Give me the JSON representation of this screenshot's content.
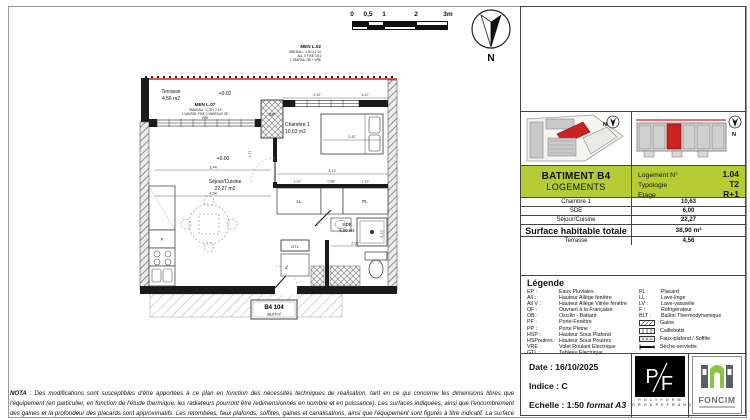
{
  "colors": {
    "accent_green": "#b5cc35",
    "highlight_red": "#cc2222"
  },
  "north_label": "N",
  "scalebar": {
    "labels": [
      "0",
      "0,5",
      "1",
      "2",
      "3m"
    ]
  },
  "plan": {
    "terrasse_label": "Terrasse",
    "terrasse_area": "4,56 m2",
    "level_top": "+0.02",
    "level_main": "+0.00",
    "men_l07": {
      "name": "MEN L.07",
      "l1": "TABLEAU : 2,70 x 2,19",
      "l2": "1 VANTAIL FIXE  2 VANTAUX OF",
      "l3": "VRE"
    },
    "men_l02": {
      "name": "MEN L.02",
      "l1": "TABLEAU : 1,00 x 2,10",
      "l2": "ALL V FIXE 0,91",
      "l3": "1 VANTAIL OB + VRE"
    },
    "chambre_label": "Chambre 1",
    "chambre_area": "10,63 m2",
    "sejour_label": "Séjour/Cuisine",
    "sejour_area": "22,27 m2",
    "sde_label": "SDE",
    "sde_area": "6,00 m2",
    "ep": "EP",
    "gtl": "GTL",
    "ll": "LL",
    "pl_closet": "PL",
    "pl_hall": "PL",
    "fridge": "F",
    "tag_line1": "B4 104",
    "tag_line2": "38,67m²",
    "dims": {
      "top1": "2,57",
      "top2": "3,47",
      "bed": "2,87",
      "mid": "3,12",
      "c1": "1,10",
      "c2": "0,88",
      "c3": "1,29",
      "sej1": "3,44",
      "sej2": "4,54",
      "sej_h": "1,71",
      "sde_w": "2,02",
      "sde_h": "2,10"
    }
  },
  "titleblock": {
    "batiment": "BATIMENT B4",
    "sublabel": "LOGEMENTS",
    "fields": [
      {
        "label": "Logement N°",
        "value": "1.04"
      },
      {
        "label": "Typologie",
        "value": "T2"
      },
      {
        "label": "Etage",
        "value": "R+1"
      }
    ],
    "rows": [
      {
        "label": "Chambre 1",
        "value": "10,63"
      },
      {
        "label": "SDE",
        "value": "6,00"
      },
      {
        "label": "Séjour/Cuisine",
        "value": "22,27"
      }
    ],
    "total_label": "Surface habitable totale",
    "total_value": "38,90 m²",
    "extra_row": {
      "label": "Terrasse",
      "value": "4,56"
    }
  },
  "legend": {
    "title": "Légende",
    "abbr_left": [
      {
        "abbr": "EP :",
        "desc": "Eaux Pluviales"
      },
      {
        "abbr": "All :",
        "desc": "Hauteur Allège fenêtre"
      },
      {
        "abbr": "All V :",
        "desc": "Hauteur Allège Vitrée fenêtre"
      },
      {
        "abbr": "OF :",
        "desc": "Ouvrant à la Française"
      },
      {
        "abbr": "OB :",
        "desc": "Oscillo - Battant"
      },
      {
        "abbr": "PF :",
        "desc": "Porte-Fenêtre"
      },
      {
        "abbr": "PP :",
        "desc": "Porte Pleine"
      },
      {
        "abbr": "HSP :",
        "desc": "Hauteur Sous Plafond"
      },
      {
        "abbr": "HSPoutres :",
        "desc": "Hauteur Sous Poutres"
      },
      {
        "abbr": "VRE :",
        "desc": "Volet Roulant Electrique"
      },
      {
        "abbr": "GTL :",
        "desc": "Tableau Electrique"
      }
    ],
    "abbr_right": [
      {
        "abbr": "PL :",
        "desc": "Placard"
      },
      {
        "abbr": "LL :",
        "desc": "Lave-linge"
      },
      {
        "abbr": "LV :",
        "desc": "Lave-vaisselle"
      },
      {
        "abbr": "F :",
        "desc": "Réfrigérateur"
      },
      {
        "abbr": "BLT :",
        "desc": "Ballon Thermodynamique"
      }
    ],
    "symbols": [
      {
        "label": "Gaine"
      },
      {
        "label": "Caillebotis"
      },
      {
        "label": "Faux-plafond / Soffite"
      },
      {
        "label": "Sèche-serviette"
      }
    ]
  },
  "footer": {
    "date": "Date : 16/10/2025",
    "indice": "Indice : C",
    "echelle": "Echelle : 1:50",
    "echelle_format": "format A3"
  },
  "logos": {
    "polyform_p": "P",
    "polyform_f": "F",
    "polyform_name": "P O L Y F O R M",
    "polyform_sub": "G R O U P E   F R A N C",
    "foncim_name": "FONCIM"
  },
  "nota": {
    "bold": "NOTA",
    "text": " : Des modifications sont susceptibles d'être apportées à ce plan en fonction des nécessités techniques de réalisation, tant en ce qui concerne les dimensions libres que l'équipement (en particulier, en fonction de l'étude thermique, les radiateurs pourront être redimensionnés en nombre et en puissance). Les surfaces indiquées, ainsi que l'encombrement des gaines et la profondeur des placards sont approximatifs. Les retombées, faux plafonds, soffites, gaines et canalisations, ainsi que l'équipement sont figurés à titre indicatif. La surface globale peut varier de plus ou moins 5%."
  }
}
